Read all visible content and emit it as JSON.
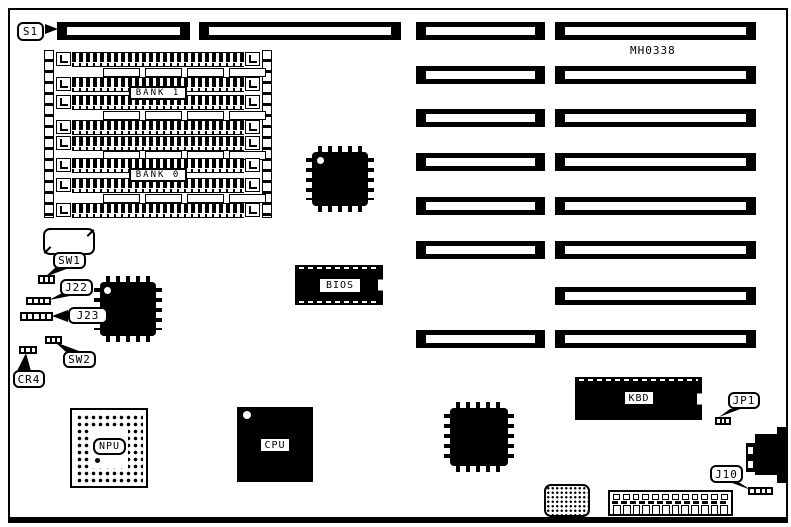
{
  "board": {
    "part_number": "MH0338",
    "callouts": {
      "s1": "S1",
      "sw1": "SW1",
      "j22": "J22",
      "j23": "J23",
      "sw2": "SW2",
      "cr4": "CR4",
      "jp1": "JP1",
      "j10": "J10"
    },
    "chips": {
      "bios": "BIOS",
      "kbd": "KBD",
      "npu": "NPU",
      "cpu": "CPU"
    },
    "memory": {
      "bank1": "BANK 1",
      "bank0": "BANK 0"
    }
  }
}
